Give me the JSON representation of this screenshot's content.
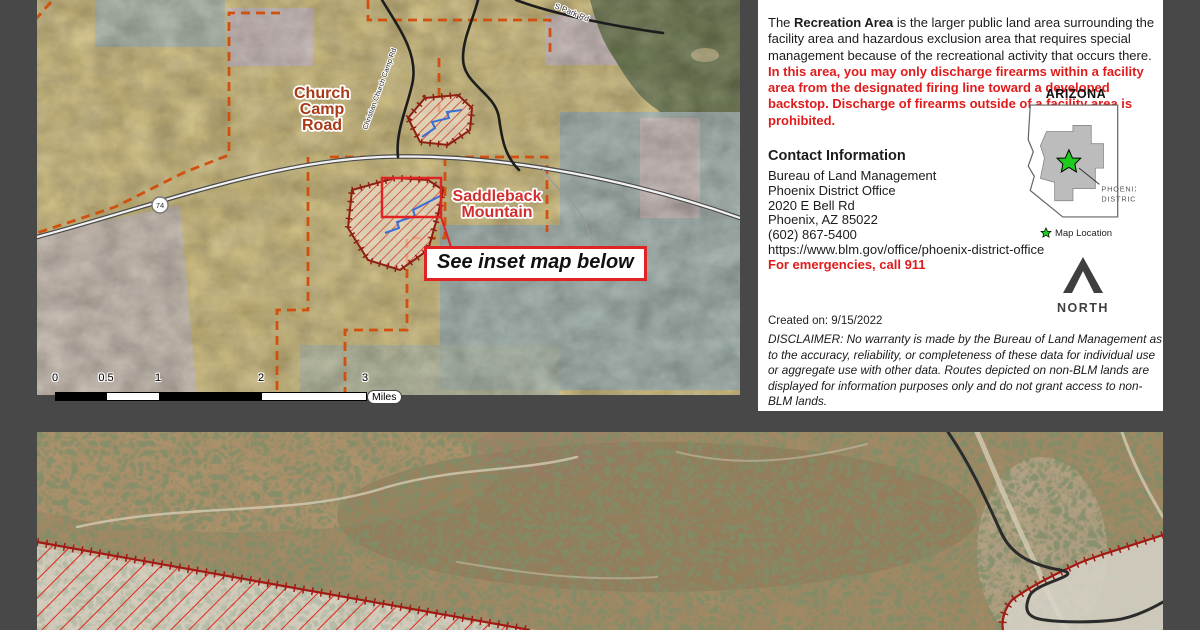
{
  "colors": {
    "background": "#484848",
    "panel_bg": "#ffffff",
    "warning_red": "#e01b1b",
    "boundary_orange": "#d2500f",
    "facility_border_red": "#8e1f12",
    "highlight_red": "#e02424",
    "label_brown": "#a83a18",
    "label_red": "#d22f2f",
    "stream_blue": "#3a6fd6",
    "star_green": "#1ecb1e",
    "north_gray": "#3f3f3f"
  },
  "main_map": {
    "labels": {
      "church_line1": "Church",
      "church_line2": "Camp",
      "church_line3": "Road",
      "saddleback_line1": "Saddleback",
      "saddleback_line2": "Mountain",
      "christian_church_camp_rd": "Christian Church Camp Rd",
      "s_park_rd": "S Park Rd",
      "route_shield": "74"
    },
    "callout": "See inset map below",
    "scalebar": {
      "ticks": [
        "0",
        "0.5",
        "1",
        "2",
        "3"
      ],
      "unit": "Miles"
    }
  },
  "info_panel": {
    "intro": {
      "t1": "The ",
      "b1": "Recreation Area",
      "t2": " is the larger public land area surrounding the facility area and hazardous exclusion area that requires special management because of the recreational activity that occurs there. ",
      "warning": "In this area, you may only discharge firearms within a facility area from the designated firing line toward a developed backstop. Discharge of firearms outside of a facility area is prohibited."
    },
    "contact": {
      "heading": "Contact Information",
      "lines": [
        "Bureau of Land Management",
        "Phoenix District Office",
        "2020 E Bell Rd",
        "Phoenix, AZ 85022",
        "(602) 867-5400",
        "https://www.blm.gov/office/phoenix-district-office"
      ],
      "emergency": "For emergencies, call 911"
    },
    "arizona": {
      "title": "ARIZONA",
      "district_line1": "PHOENIX",
      "district_line2": "DISTRICT",
      "legend": "Map Location"
    },
    "north_label": "NORTH",
    "created": "Created on: 9/15/2022",
    "disclaimer": "DISCLAIMER: No warranty is made by the Bureau of Land Management as to the accuracy, reliability, or completeness of these data for individual use or aggregate use with other data. Routes depicted on non-BLM lands are displayed for information purposes only and do not grant access to non-BLM lands."
  }
}
